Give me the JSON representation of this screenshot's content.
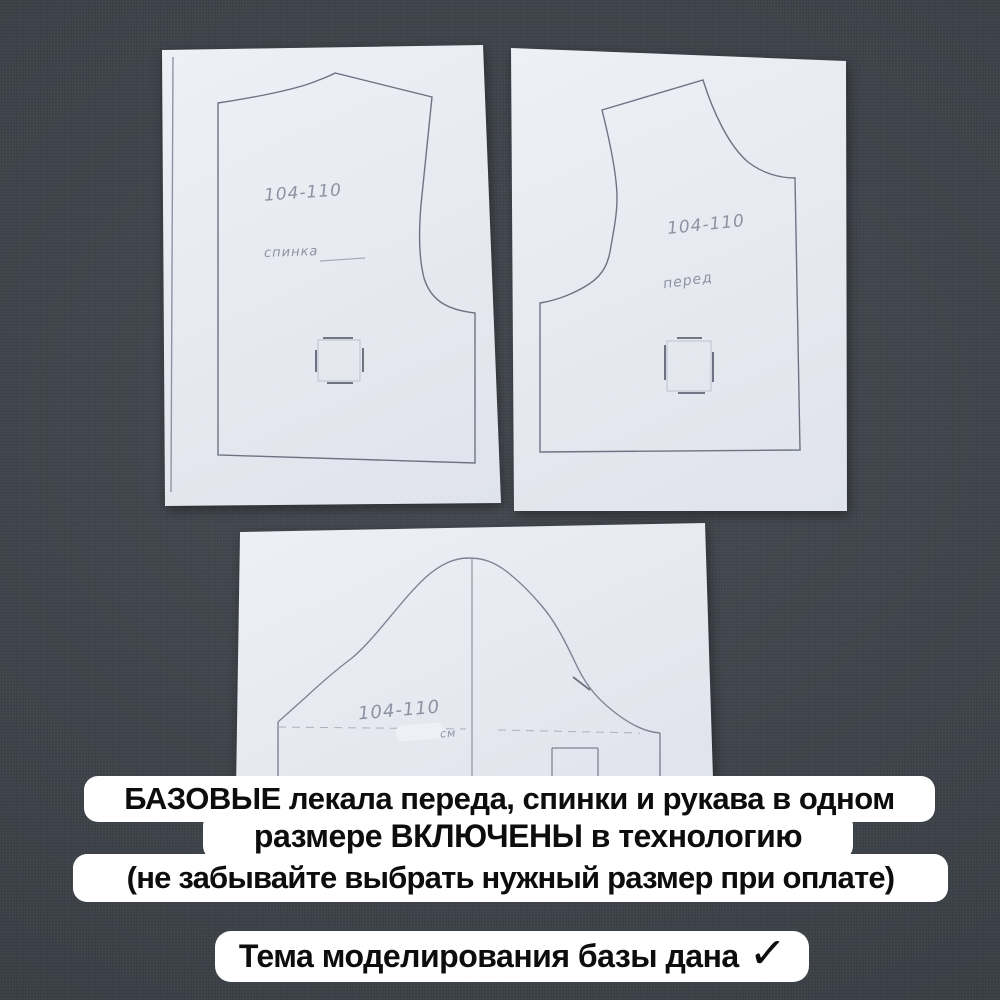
{
  "photo": {
    "background_color": "#3e434b",
    "paper_color": "#e8eaf1",
    "outline_color": "#6e7383",
    "pencil_color": "#8d92a3",
    "sheets": {
      "back": {
        "size_label": "104-110",
        "name_label": "спинка"
      },
      "front": {
        "size_label": "104-110",
        "name_label": "перед"
      },
      "sleeve": {
        "size_label": "104-110",
        "unit_label": "см"
      }
    }
  },
  "caption": {
    "line1": "БАЗОВЫЕ лекала переда, спинки и рукава в одном",
    "line2": "размере ВКЛЮЧЕНЫ в технологию",
    "line3": "(не забывайте выбрать нужный размер при оплате)",
    "box_color": "#ffffff",
    "text_color": "#0d0d0d"
  },
  "footer": {
    "text": "Тема моделирования базы дана",
    "check_icon": "✓"
  }
}
